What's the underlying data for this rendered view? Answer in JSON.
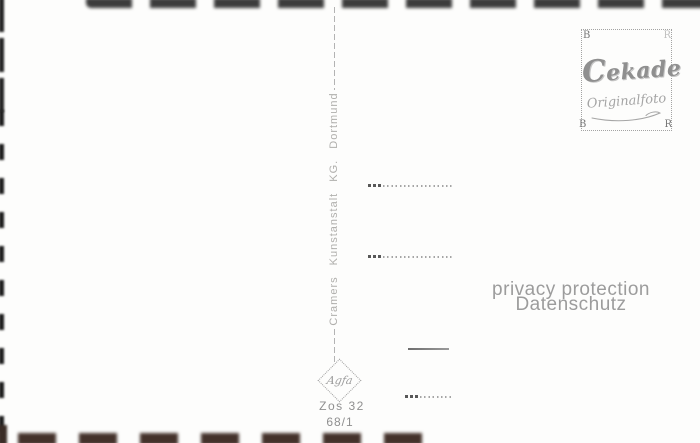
{
  "postcard": {
    "publisher": {
      "imprint": "Cramers  Kunstanstalt  KG.  Dortmund",
      "order_code": "Zos 32",
      "series_code": "68/1",
      "paper_logo": "Agfa"
    },
    "stamp_box": {
      "corner_letters": {
        "top_left": "B",
        "top_right": "R",
        "bottom_left": "B",
        "bottom_right": "R"
      },
      "brand_initial": "C",
      "brand_rest": "ekade",
      "subtitle": "Originalfoto"
    },
    "watermark": {
      "line1": "privacy protection",
      "line2": "Datenschutz"
    },
    "colors": {
      "background": "#fdfdfc",
      "faint_gray_text": "#b0afac",
      "gray_text": "#8f8f8f",
      "watermark_gray": "#9c9c9c",
      "top_edge_mark": "#3c3c3c",
      "bottom_edge_mark": "#44322b",
      "left_edge_mark": "#1c1c1c"
    }
  }
}
